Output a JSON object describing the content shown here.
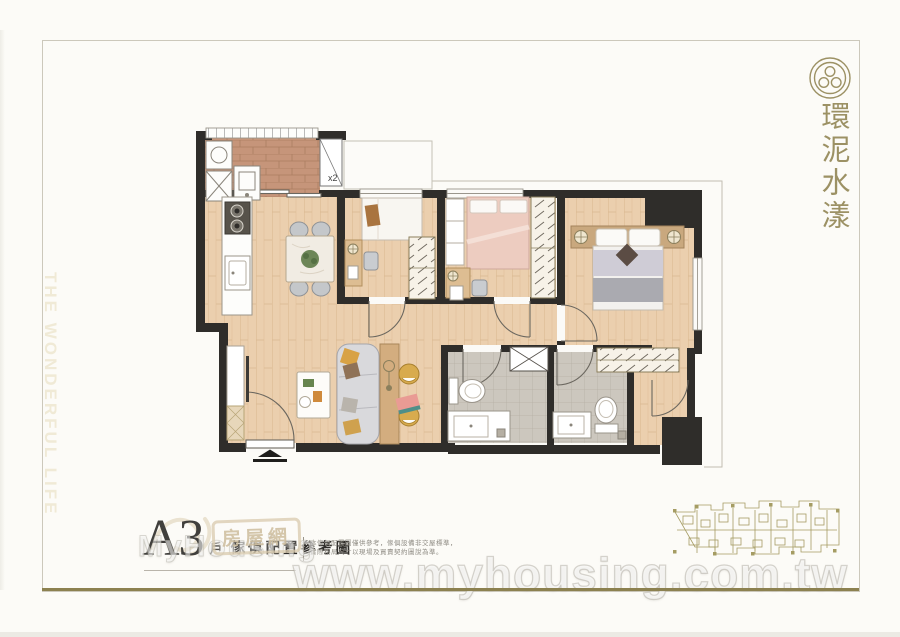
{
  "brand": {
    "emblem_icon": "trefoil-seal-icon",
    "title_vertical": "環泥水漾",
    "accent_color": "#9c9164"
  },
  "side_slogan": "THE WONDERFUL LIFE",
  "unit": {
    "code": "A3",
    "code_suffix": "戶",
    "caption": "傢俱配置參考圖",
    "separator": "|",
    "disclaimer_line1": "本傢俱配置圖僅供參考，傢俱設備非交屋標準，",
    "disclaimer_line2": "實際格局尺寸以現場及買賣契約圖說為準。"
  },
  "floorplan": {
    "cabinet_label": "x2"
  },
  "watermark": {
    "site_url": "www.myhousing.com.tw",
    "stamp_text": "房屋網",
    "ghost_text": "MyHousing"
  },
  "palette": {
    "paper": "#fcfbf7",
    "frame_line": "#ccc8bb",
    "gold_rule": "#8c8150",
    "wall": "#2f2d2a",
    "wood": "#ebcfae",
    "brick": "#c6957a",
    "tile": "#ccc7be"
  }
}
